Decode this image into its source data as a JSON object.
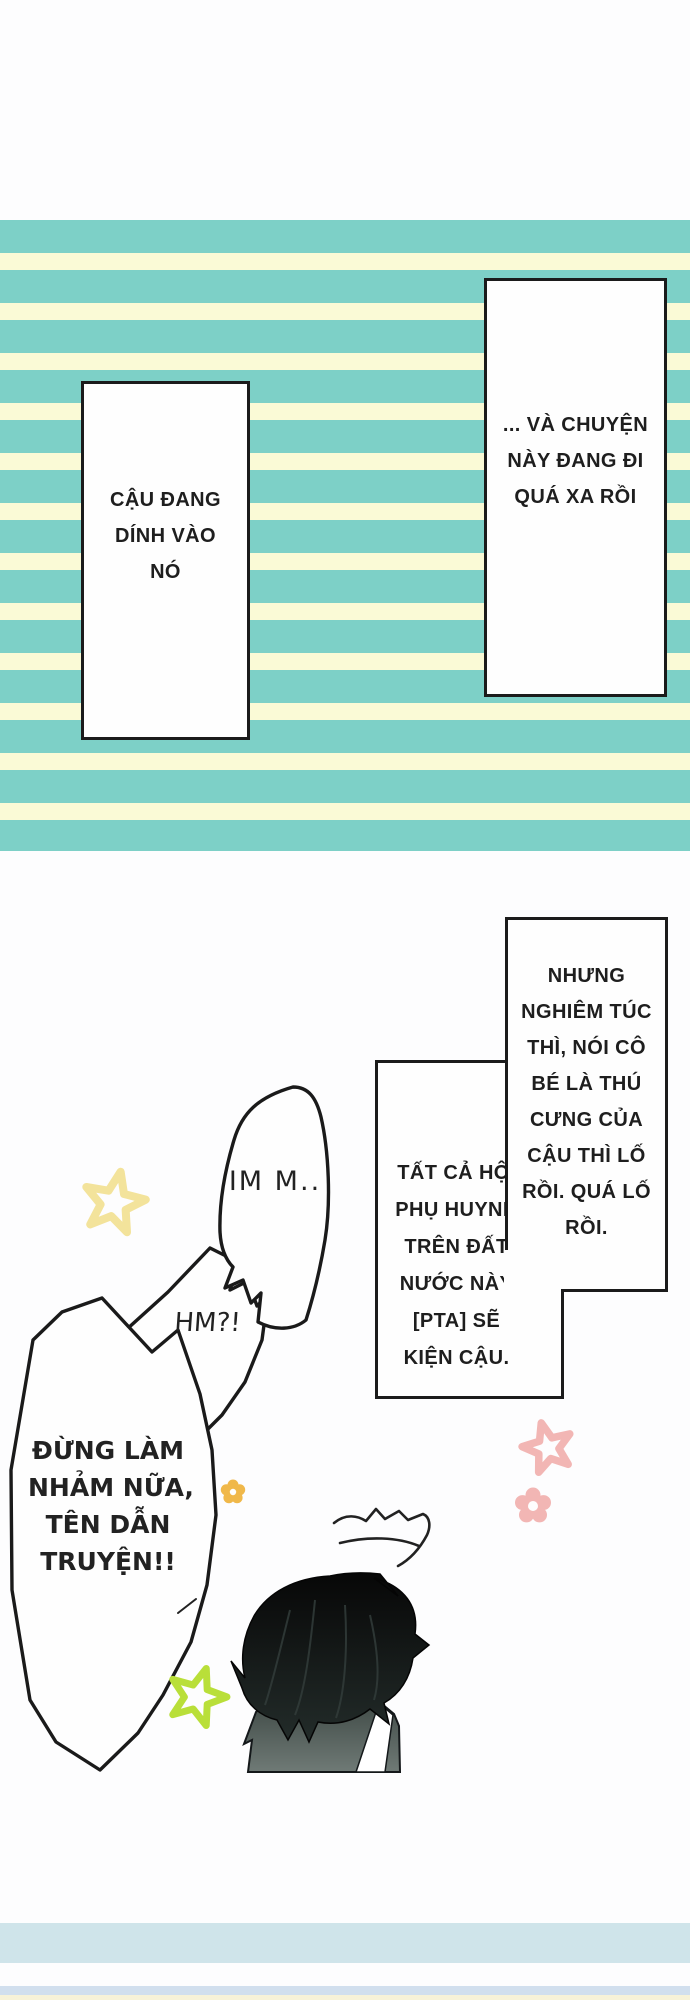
{
  "page": {
    "kind": "manga-webtoon-page"
  },
  "colors": {
    "stripe_teal": "#7dd0c7",
    "stripe_cream": "#fafad6",
    "box_border": "#1b1b1b",
    "footer_band1": "#cfe4ea",
    "footer_band2": "#d1dfee",
    "footer_band3": "#f7f2d8",
    "star_yellow": "#f3e39b",
    "star_pink": "#f2b6b4",
    "star_green": "#b9df39",
    "flower_orange": "#f0b84a"
  },
  "boxes": {
    "top_left": {
      "lines": [
        "CẬU ĐANG",
        "DÍNH VÀO",
        "NÓ"
      ]
    },
    "top_right": {
      "lines": [
        "... VÀ CHUYỆN",
        "NÀY ĐANG ĐI",
        "QUÁ XA RỒI"
      ]
    },
    "serious": {
      "lines": [
        "NHƯNG",
        "NGHIÊM TÚC",
        "THÌ, NÓI CÔ",
        "BÉ LÀ THÚ",
        "CƯNG CỦA",
        "CẬU THÌ LỐ",
        "RỒI. QUÁ LỐ",
        "RỒI."
      ]
    },
    "pta": {
      "lines": [
        "TẤT CẢ HỘI",
        "PHỤ HUYNH",
        "TRÊN ĐẤT",
        "NƯỚC NÀY",
        "[PTA] SẼ",
        "KIỆN CẬU."
      ]
    }
  },
  "bubbles": {
    "im": {
      "text": "IM M.."
    },
    "hm": {
      "text": "HM?!"
    },
    "dung": {
      "lines": [
        "ĐỪNG LÀM",
        "NHẢM NỮA,",
        "TÊN DẪN",
        "TRUYỆN!!"
      ]
    }
  }
}
